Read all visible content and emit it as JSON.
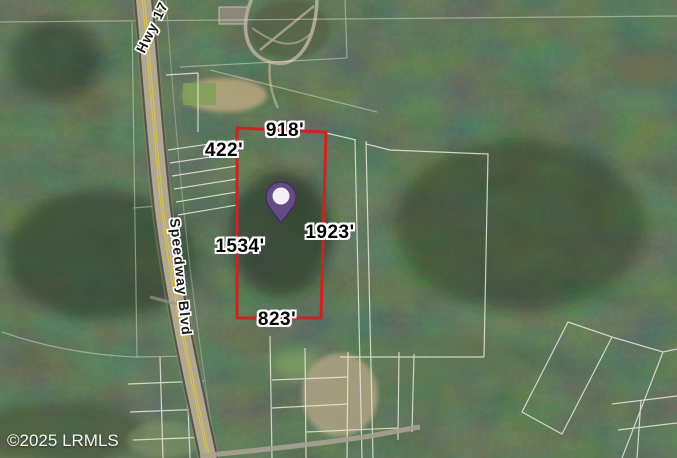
{
  "map": {
    "watermark": "©2025 LRMLS",
    "roads": {
      "highway_label": "Hwy 17",
      "boulevard_label": "Speedway Blvd"
    },
    "subject_parcel": {
      "outline_color": "#cb2423",
      "dimensions": {
        "top": "918'",
        "upper_left": "422'",
        "left": "1534'",
        "right": "1923'",
        "bottom": "823'"
      }
    },
    "pin": {
      "color": "#654a85",
      "inner_color": "#f3edf7",
      "edge_color": "#3e2d5a"
    }
  }
}
